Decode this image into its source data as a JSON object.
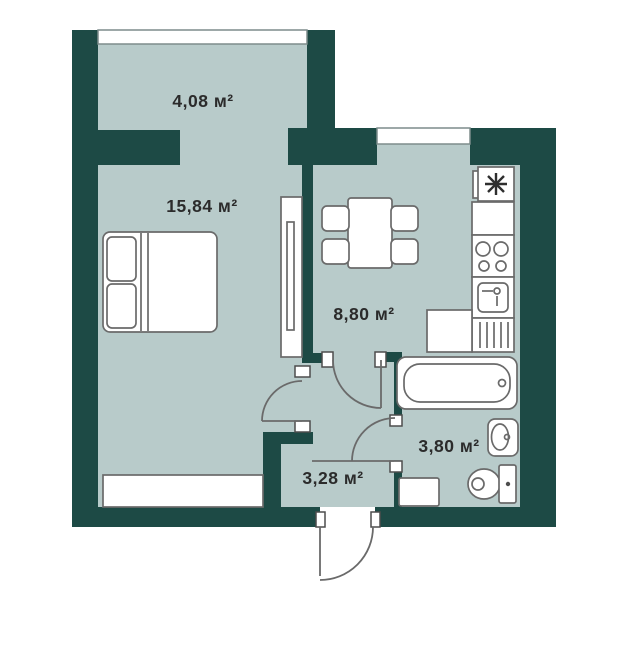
{
  "plan_title": "apartment-floor-plan",
  "rooms": {
    "balcony": {
      "label": "4,08 м²"
    },
    "bedroom": {
      "label": "15,84 м²"
    },
    "kitchen": {
      "label": "8,80 м²"
    },
    "hallway": {
      "label": "3,28 м²"
    },
    "bathroom": {
      "label": "3,80 м²"
    }
  },
  "colors": {
    "wall": "#1d4a45",
    "floor": "#b8cbca",
    "background": "#ffffff",
    "outline": "#6a6a6a",
    "jamb_outline": "#4d4d4d",
    "text": "#2b2b2b"
  }
}
